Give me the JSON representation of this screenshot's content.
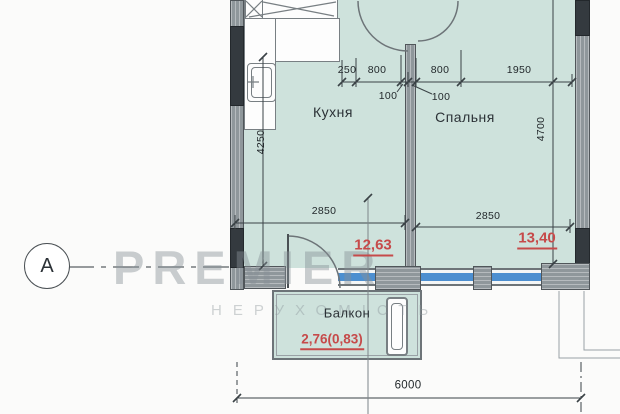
{
  "plan": {
    "axis_label": "А",
    "rooms": {
      "kitchen": "Кухня",
      "bedroom": "Спальня",
      "balcony": "Балкон"
    },
    "areas": {
      "kitchen": "12,63",
      "bedroom": "13,40",
      "balcony": "2,76(0,83)"
    },
    "dims": {
      "top": [
        "250",
        "800",
        "100",
        "100",
        "800",
        "1950"
      ],
      "kitchen_height": "4250",
      "bedroom_height": "4700",
      "kitchen_width": "2850",
      "bedroom_width": "2850",
      "total_width": "6000"
    },
    "watermark": {
      "brand": "PREMIER",
      "tagline": "НЕРУХОМІСТЬ"
    },
    "colors": {
      "floor": "#cee2dc",
      "wall": "#8f979b",
      "wall_dark": "#343a3f",
      "window": "#4d8fd0",
      "area_text": "#c64a4a"
    }
  }
}
